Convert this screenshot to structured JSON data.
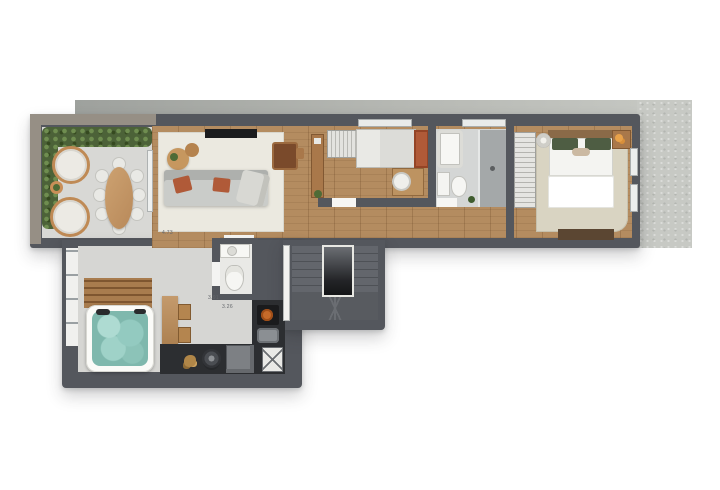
{
  "scene": {
    "type": "3d-rendered-floor-plan",
    "description": "Top-down architectural render of a duplex upper floor with terrace, living room, two bedrooms, bathrooms, spa lounge with hot tub, barbecue kitchen and U-shaped staircase",
    "background": "#ffffff"
  },
  "palette": {
    "wall": "#54575d",
    "wall_taupe": "#968f85",
    "slab_band": "#a7aaa6",
    "slab_concrete": "#c7c9c4",
    "wood_floor": "#b48c60",
    "terrace_floor": "#d8d8d5",
    "spa_floor": "#d6d6d3",
    "bath_floor": "#d4d6d5",
    "living_rug": "#ebe9e0",
    "master_rug": "#d9d4c2",
    "hedge_green": "#4c6238",
    "sofa_gray": "#caccc9",
    "terracotta": "#b05a38",
    "hot_tub_teal": "#7fb8ad",
    "white_fixture": "#f4f4f1",
    "counter_dark": "#2c2e31",
    "stair_gray": "#5d6066",
    "pillow_green": "#4e5d43",
    "tv_black": "#1b1c1e"
  },
  "rooms": [
    {
      "name": "terrace",
      "furniture": [
        "perimeter-hedge-planter",
        "round-lounge-chair",
        "round-lounge-chair",
        "plant-side-table",
        "oval-wood-dining-table",
        "eight-dining-chairs"
      ]
    },
    {
      "name": "living-room",
      "furniture": [
        "area-rug",
        "wall-tv-panel",
        "round-coffee-tables",
        "gray-sofa-terracotta-cushions",
        "fabric-chaise",
        "wood-frame-armchair",
        "side-table"
      ]
    },
    {
      "name": "hallway",
      "furniture": [
        "wood-sideboard",
        "potted-plant"
      ]
    },
    {
      "name": "bedroom-1",
      "furniture": [
        "open-wardrobe",
        "single-bed-terracotta-headboard",
        "work-desk",
        "desk-chair"
      ]
    },
    {
      "name": "bathroom-1",
      "furniture": [
        "bathtub",
        "walk-in-shower",
        "washbasin",
        "toilet",
        "small-plant"
      ]
    },
    {
      "name": "master-bedroom",
      "furniture": [
        "open-wardrobe",
        "double-bed-green-pillows",
        "area-rug",
        "round-table-lamp",
        "nightstand-with-lamp",
        "foot-bench"
      ]
    },
    {
      "name": "spa-lounge",
      "furniture": [
        "glazed-wall",
        "wood-deck-slats",
        "square-hot-tub",
        "bar-table",
        "two-stools"
      ]
    },
    {
      "name": "wc",
      "furniture": [
        "washbasin-counter",
        "toilet"
      ]
    },
    {
      "name": "barbecue-kitchen",
      "furniture": [
        "cooktop-with-pan",
        "prep-sink",
        "round-kamado-grill",
        "mini-fridge",
        "x-crate",
        "bottles"
      ]
    },
    {
      "name": "staircase",
      "furniture": [
        "u-shaped-stair-flight",
        "stair-void",
        "open-door"
      ]
    }
  ],
  "annotations": {
    "dimensions": [
      {
        "id": "living-width",
        "text": "4.73"
      },
      {
        "id": "spa-width",
        "text": "3.91"
      },
      {
        "id": "spa-depth",
        "text": "3.26"
      }
    ]
  }
}
